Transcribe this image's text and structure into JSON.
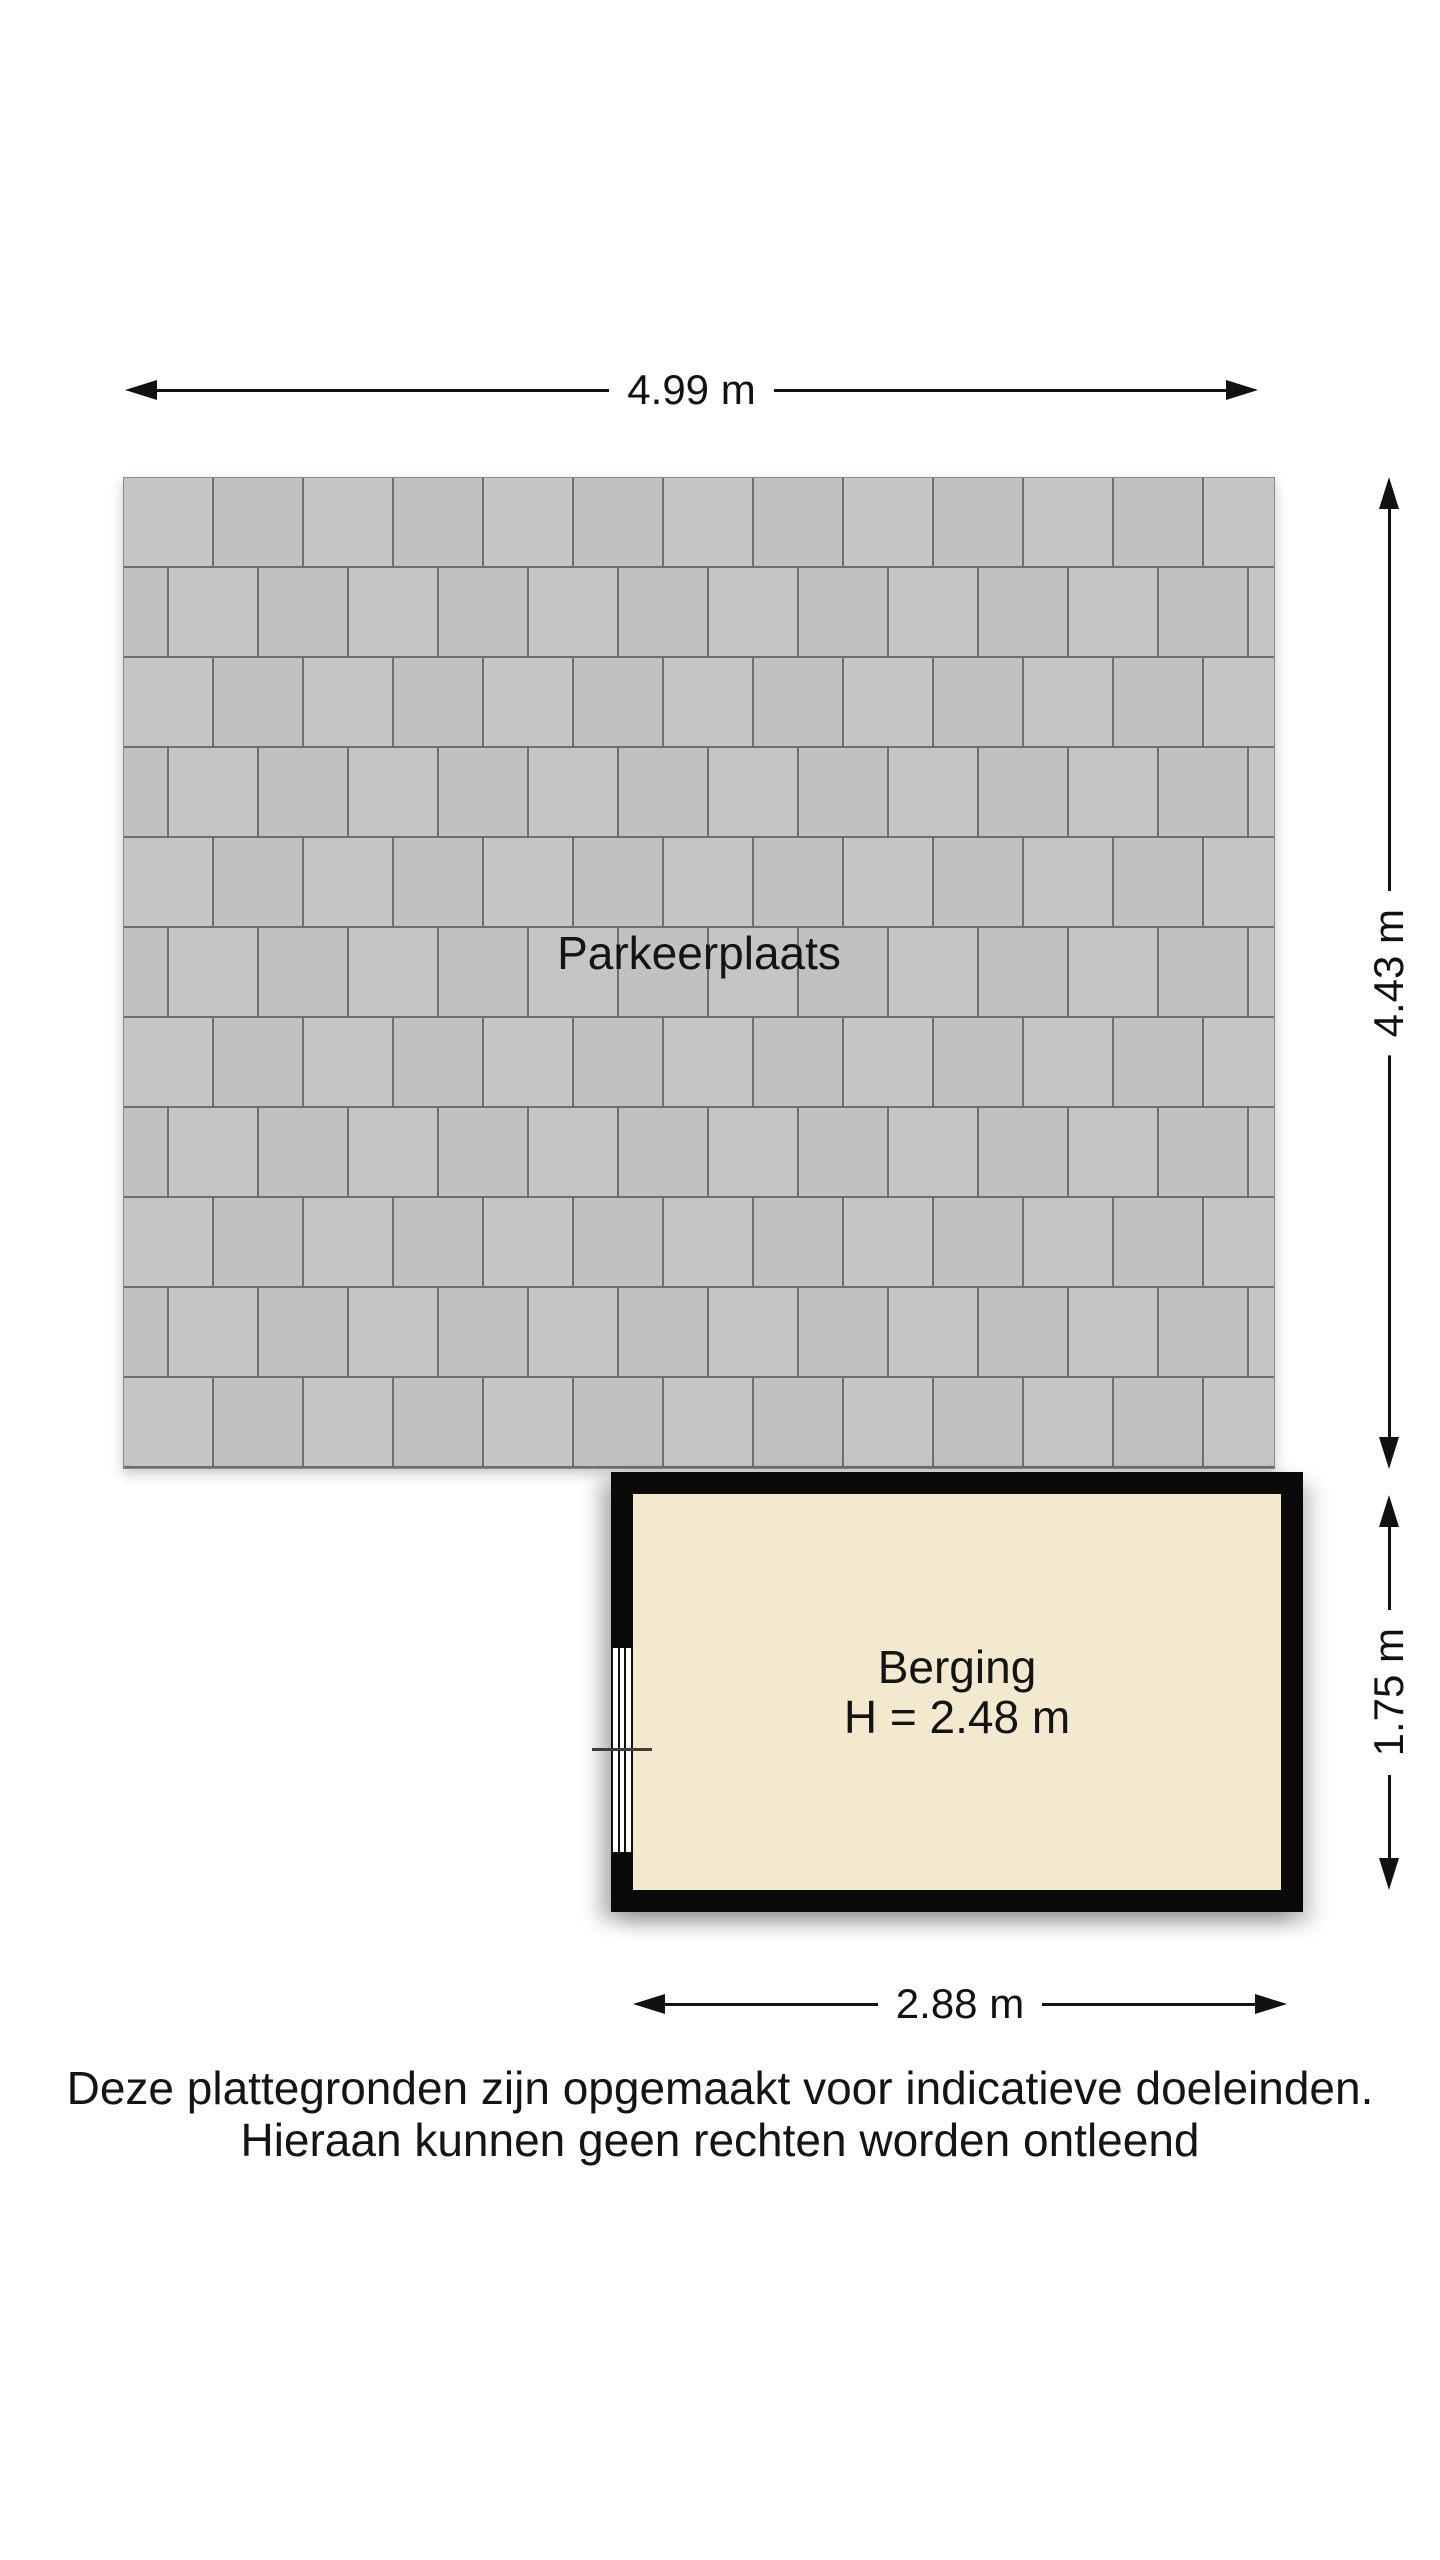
{
  "floorplan": {
    "parking": {
      "label": "Parkeerplaats"
    },
    "storage": {
      "label": "Berging",
      "height_label": "H = 2.48 m"
    },
    "dimensions": {
      "top_width": "4.99 m",
      "right_upper_height": "4.43 m",
      "right_lower_height": "1.75 m",
      "bottom_width": "2.88 m"
    },
    "disclaimer": {
      "line1": "Deze plattegronden zijn opgemaakt voor indicatieve doeleinden.",
      "line2": "Hieraan kunnen geen rechten worden ontleend"
    },
    "colors": {
      "paver_fill": "#c6c5c3",
      "paver_fill_alt": "#c2c1bf",
      "paver_joint": "#6f6e6c",
      "wall": "#0a0a0a",
      "room_floor": "#f2e9cf",
      "background": "#ffffff",
      "text": "#141414"
    }
  }
}
